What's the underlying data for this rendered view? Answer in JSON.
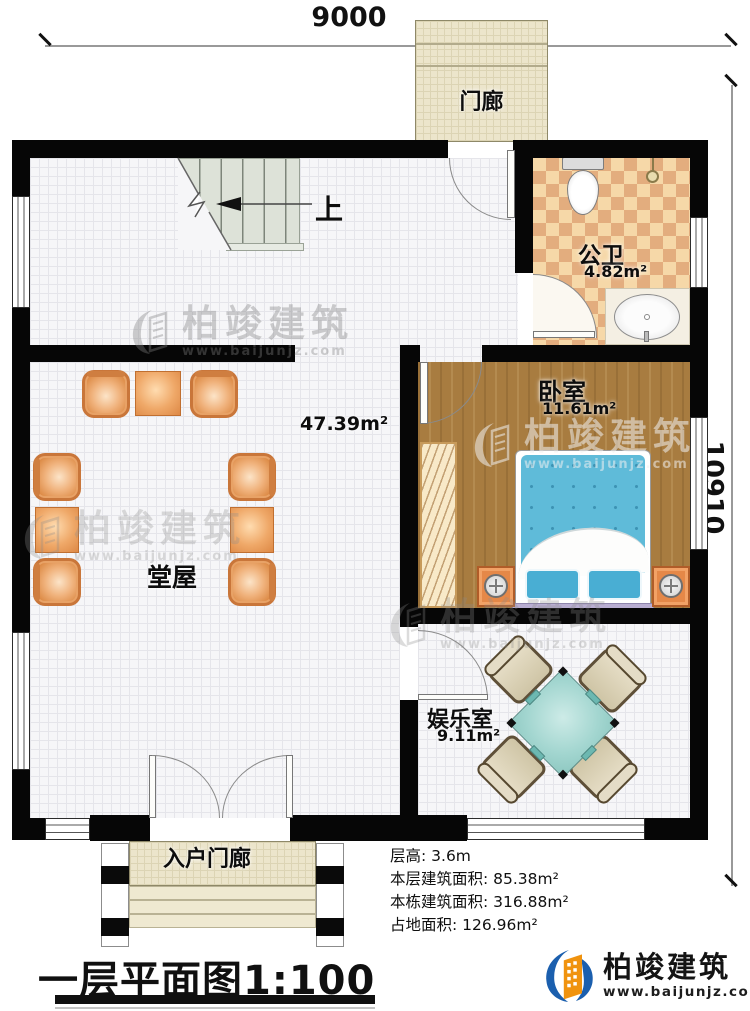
{
  "dimensions": {
    "top": "9000",
    "right": "10910"
  },
  "rooms": {
    "porch": {
      "name": "门廊"
    },
    "bath": {
      "name": "公卫",
      "area": "4.82m²"
    },
    "bedroom": {
      "name": "卧室",
      "area": "11.61m²"
    },
    "hall": {
      "name": "堂屋",
      "area": "47.39m²"
    },
    "entertainment": {
      "name": "娱乐室",
      "area": "9.11m²"
    },
    "entry_porch": {
      "name": "入户门廊"
    },
    "stairs": {
      "direction_label": "上"
    }
  },
  "info_lines": [
    "层高: 3.6m",
    "本层建筑面积: 85.38m²",
    "本栋建筑面积: 316.88m²",
    "占地面积: 126.96m²"
  ],
  "title": {
    "text": "一层平面图",
    "scale": "1:100"
  },
  "brand": {
    "name": "柏竣建筑",
    "url": "www.baijunjz.com"
  },
  "watermark": {
    "name": "柏竣建筑",
    "url": "www.baijunjz.com"
  },
  "colors": {
    "wall": "#060606",
    "brand_blue": "#1b5fae",
    "brand_orange": "#f0930f",
    "bed_blue": "#5fbbd9",
    "table_teal": "#a3d6d0",
    "wood": "#a87c40",
    "checker_light": "#f6d8a8",
    "checker_dark": "#e3ad7e"
  }
}
